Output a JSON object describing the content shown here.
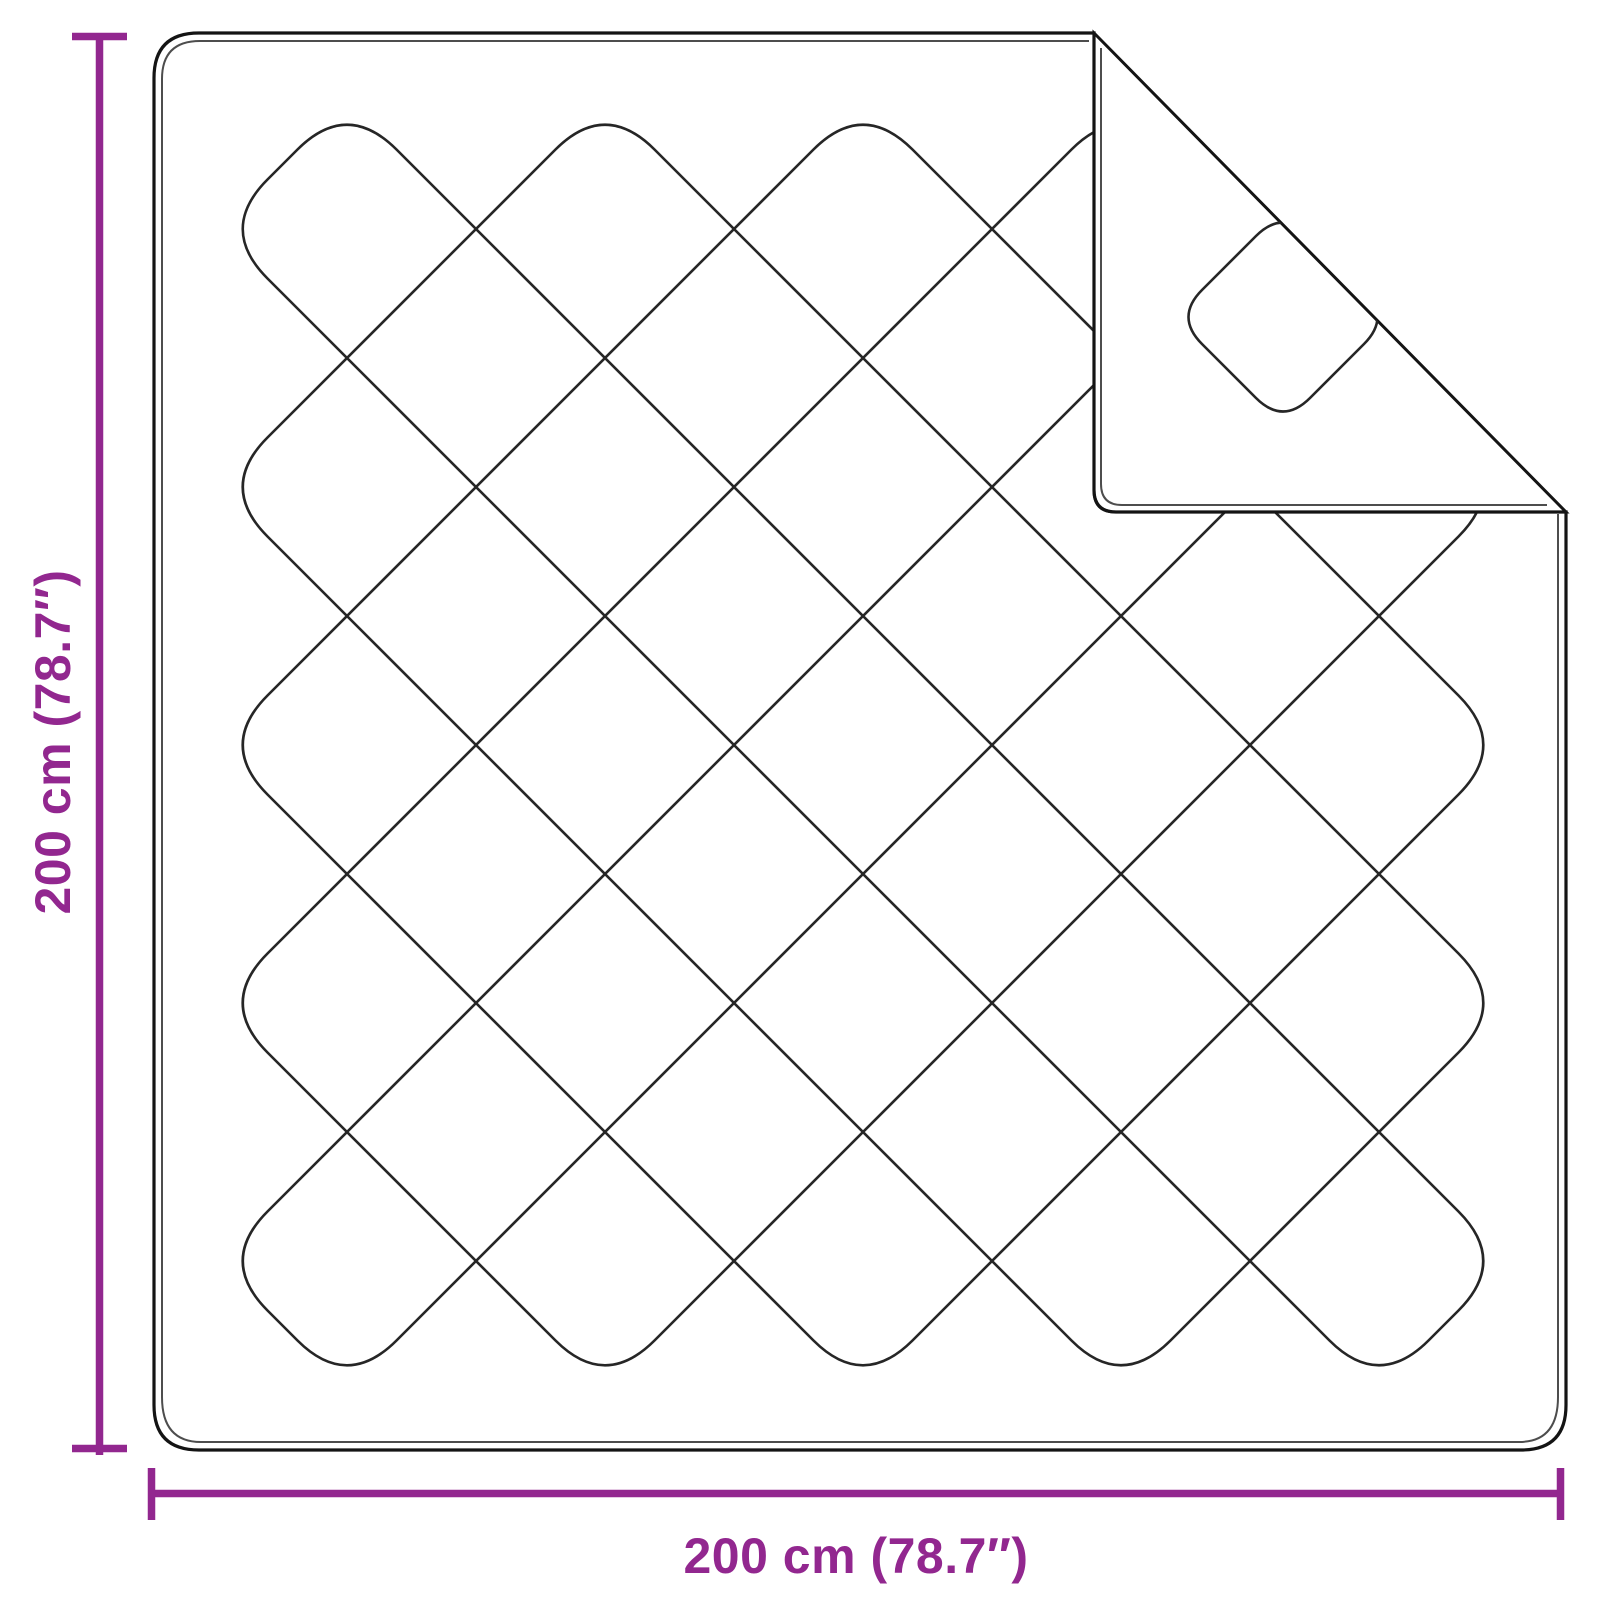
{
  "diagram": {
    "product": "quilted-blanket-with-folded-corner",
    "height_label": "200 cm (78.7″)",
    "width_label": "200 cm (78.7″)",
    "accent_color": "#92278F",
    "outline_color": "#141414",
    "stitch_color": "#262626"
  }
}
